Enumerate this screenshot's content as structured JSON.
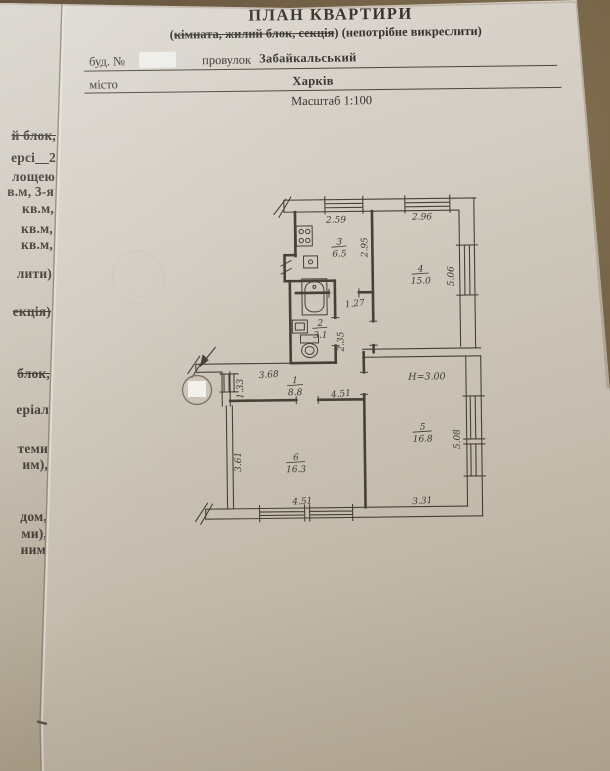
{
  "header": {
    "title": "ПЛАН КВАРТИРИ",
    "subtitle_open": "(",
    "subtitle_struck": "кімната, жилий блок, секція",
    "subtitle_close": ")",
    "subtitle_rest": " (непотрібне викреслити)",
    "bud_label": "буд. №",
    "provulok_label": "провулок",
    "street_value": "Забайкальський",
    "misto_label": "місто",
    "city_value": "Харків",
    "scale_label": "Масштаб 1:100"
  },
  "left_fragments": [
    {
      "text": "й блок,",
      "struck": true
    },
    {
      "text": "ерсі__2",
      "struck": false
    },
    {
      "text": "лощею",
      "struck": false
    },
    {
      "text": "в.м, 3-я",
      "struck": false
    },
    {
      "text": "кв.м,",
      "struck": false
    },
    {
      "text": "кв.м,",
      "struck": false
    },
    {
      "text": "кв.м,",
      "struck": false
    },
    {
      "text": "лити)",
      "struck": false
    },
    {
      "text": "екція)",
      "struck": true
    },
    {
      "text": "блок,",
      "struck": true
    },
    {
      "text": "еріал",
      "struck": false
    },
    {
      "text": "теми",
      "struck": false
    },
    {
      "text": "им),",
      "struck": false
    },
    {
      "text": "дом,",
      "struck": false
    },
    {
      "text": "ми),",
      "struck": false
    },
    {
      "text": "ним",
      "struck": false
    }
  ],
  "plan": {
    "height_note": "Н=3.00",
    "rooms": [
      {
        "num": "1",
        "area": "8.8"
      },
      {
        "num": "2",
        "area": "3.1"
      },
      {
        "num": "3",
        "area": "6.5"
      },
      {
        "num": "4",
        "area": "15.0"
      },
      {
        "num": "5",
        "area": "16.8"
      },
      {
        "num": "6",
        "area": "16.3"
      }
    ],
    "dims": {
      "kitchen_top": "2.59",
      "room4_top": "2.96",
      "kitchen_right": "2.95",
      "room4_right": "5.06",
      "corridor_width": "1.27",
      "corridor_height": "2.35",
      "hall_top": "3.68",
      "hall_left": "1.33",
      "hall_bottom": "4.51",
      "room5_right": "5.08",
      "room5_bottom": "3.31",
      "room6_left": "3.61",
      "room6_bottom": "4.51"
    }
  },
  "colors": {
    "paper": "#d3cdc3",
    "background_wood": "#6e5c44",
    "ink": "#35302a",
    "plan_line": "#474038"
  }
}
